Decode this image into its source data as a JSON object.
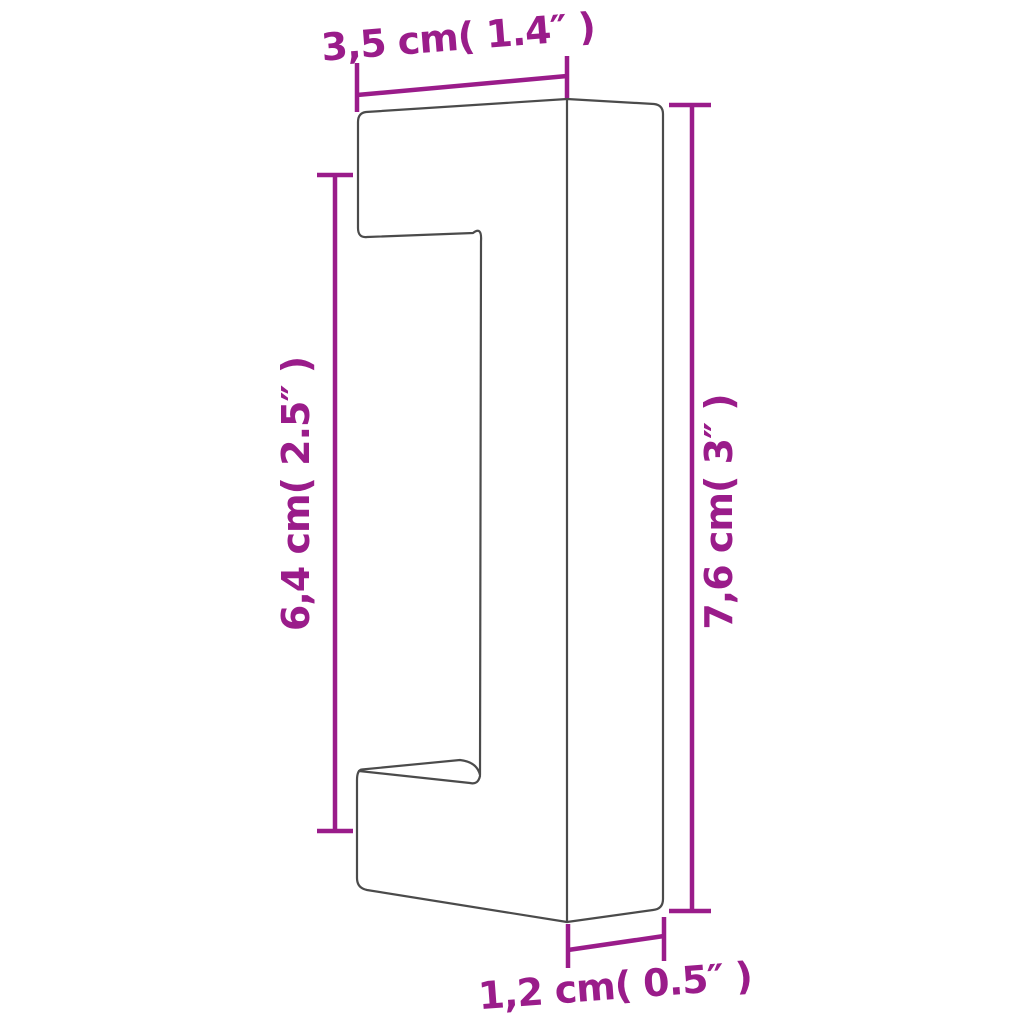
{
  "diagram": {
    "type": "technical-dimension-drawing",
    "subject": "bar pull handle",
    "colors": {
      "dimension_accent": "#9A1C8A",
      "outline": "#4B4B4B",
      "background": "#FFFFFF"
    },
    "dimensions": {
      "top": {
        "label": "3,5 cm( 1.4″ )",
        "cm": "3,5",
        "inches": "1.4″"
      },
      "left": {
        "label": "6,4 cm( 2.5″ )",
        "cm": "6,4",
        "inches": "2.5″"
      },
      "right": {
        "label": "7,6 cm( 3″ )",
        "cm": "7,6",
        "inches": "3″"
      },
      "bottom": {
        "label": "1,2 cm( 0.5″ )",
        "cm": "1,2",
        "inches": "0.5″"
      }
    }
  }
}
